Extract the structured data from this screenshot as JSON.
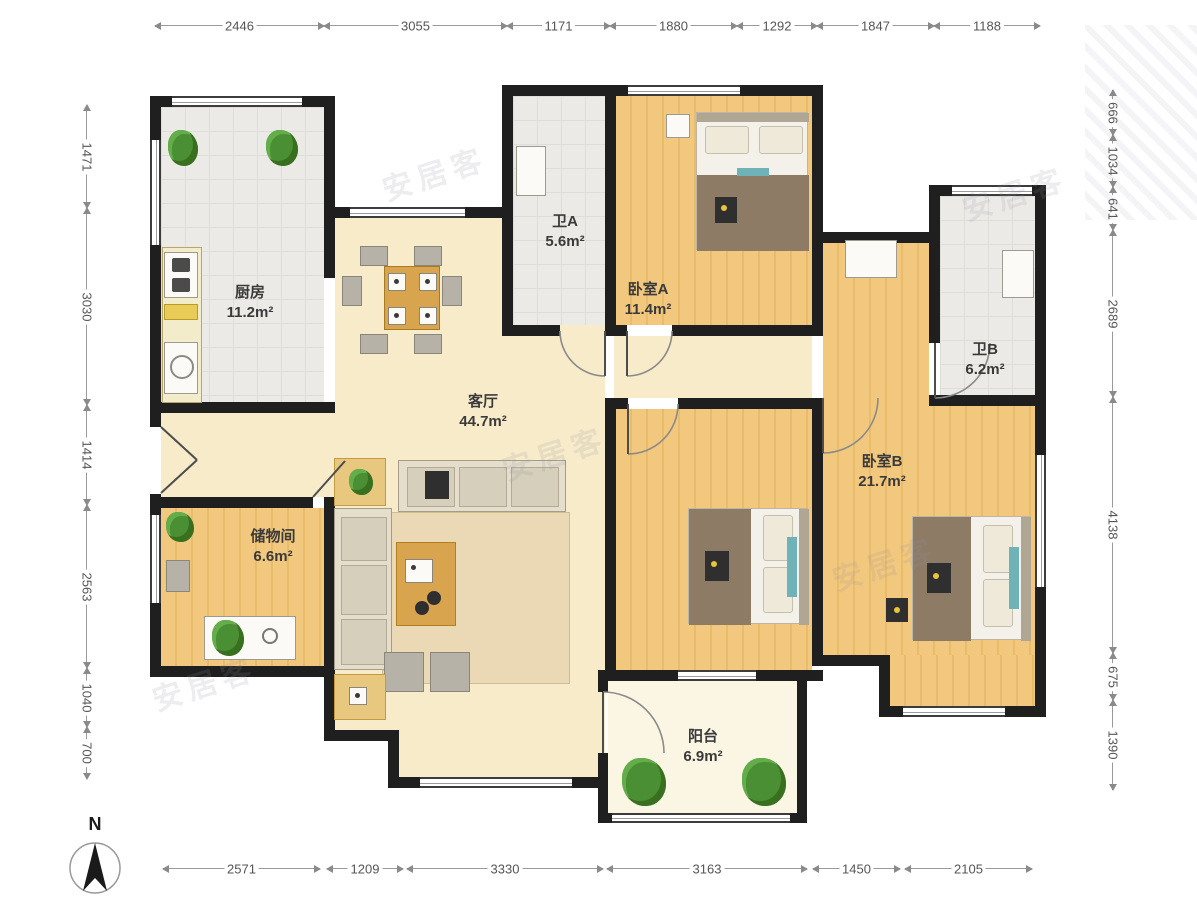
{
  "watermark_text": "安居客",
  "compass": {
    "label": "N"
  },
  "rooms": [
    {
      "name": "厨房",
      "area": "11.2m²"
    },
    {
      "name": "卫A",
      "area": "5.6m²"
    },
    {
      "name": "卧室A",
      "area": "11.4m²"
    },
    {
      "name": "卫B",
      "area": "6.2m²"
    },
    {
      "name": "客厅",
      "area": "44.7m²"
    },
    {
      "name": "卧室B",
      "area": "21.7m²"
    },
    {
      "name": "储物间",
      "area": "6.6m²"
    },
    {
      "name": "阳台",
      "area": "6.9m²"
    }
  ],
  "dimensions": {
    "top": [
      {
        "label": "2446",
        "from": 155,
        "to": 324
      },
      {
        "label": "3055",
        "from": 324,
        "to": 507
      },
      {
        "label": "1171",
        "from": 507,
        "to": 610
      },
      {
        "label": "1880",
        "from": 610,
        "to": 737
      },
      {
        "label": "1292",
        "from": 737,
        "to": 817
      },
      {
        "label": "1847",
        "from": 817,
        "to": 934
      },
      {
        "label": "1188",
        "from": 934,
        "to": 1040
      }
    ],
    "left": [
      {
        "label": "1471",
        "from": 105,
        "to": 208
      },
      {
        "label": "3030",
        "from": 208,
        "to": 405
      },
      {
        "label": "1414",
        "from": 405,
        "to": 505
      },
      {
        "label": "2563",
        "from": 505,
        "to": 668
      },
      {
        "label": "1040",
        "from": 668,
        "to": 727
      },
      {
        "label": "700",
        "from": 727,
        "to": 779
      }
    ],
    "right": [
      {
        "label": "666",
        "from": 90,
        "to": 135
      },
      {
        "label": "1034",
        "from": 135,
        "to": 187
      },
      {
        "label": "641",
        "from": 187,
        "to": 230
      },
      {
        "label": "2689",
        "from": 230,
        "to": 397
      },
      {
        "label": "4138",
        "from": 397,
        "to": 653
      },
      {
        "label": "675",
        "from": 653,
        "to": 700
      },
      {
        "label": "1390",
        "from": 700,
        "to": 790
      }
    ],
    "bottom": [
      {
        "label": "2571",
        "from": 163,
        "to": 320
      },
      {
        "label": "1209",
        "from": 327,
        "to": 403
      },
      {
        "label": "3330",
        "from": 407,
        "to": 603
      },
      {
        "label": "3163",
        "from": 607,
        "to": 807
      },
      {
        "label": "1450",
        "from": 813,
        "to": 900
      },
      {
        "label": "2105",
        "from": 905,
        "to": 1032
      }
    ]
  }
}
